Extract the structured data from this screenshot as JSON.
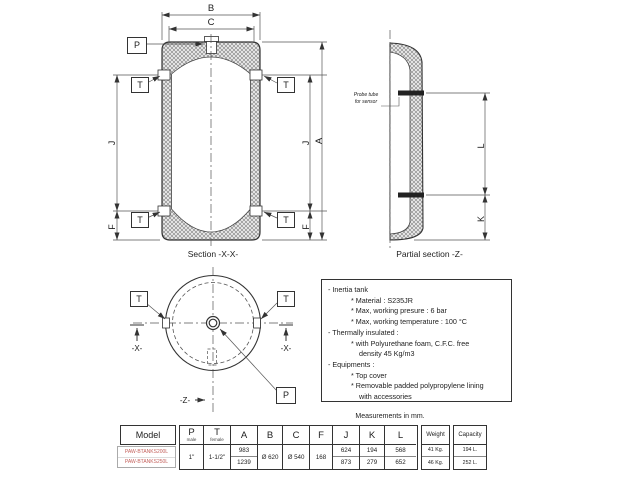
{
  "colors": {
    "line": "#333333",
    "model_text": "#c4615c"
  },
  "section_x": {
    "caption": "Section -X-X-",
    "dim_B": "B",
    "dim_C": "C",
    "dim_A": "A",
    "dim_J": "J",
    "dim_F": "F",
    "label_P": "P",
    "label_T": "T"
  },
  "partial_z": {
    "caption": "Partial section -Z-",
    "dim_L": "L",
    "dim_K": "K",
    "probe_note_line1": "Probe tube",
    "probe_note_line2": "for sensor"
  },
  "top_view": {
    "label_T": "T",
    "label_P": "P",
    "marker_x": "-X-",
    "marker_z": "-Z-"
  },
  "specs": {
    "lines": [
      "- Inertia tank",
      "* Material : S235JR",
      "* Max, working presure : 6 bar",
      "* Max, working temperature : 100 °C",
      "- Thermally insulated :",
      "* with Polyurethane foam, C.F.C. free",
      "density 45 Kg/m3",
      "- Equipments :",
      "* Top cover",
      "* Removable padded polypropylene lining",
      "with accessories"
    ]
  },
  "table": {
    "note": "Measurements in mm.",
    "model": {
      "header": "Model",
      "rows": [
        "PAW-BTANKS200L",
        "PAW-BTANKS250L"
      ]
    },
    "columns": {
      "P": {
        "label": "P",
        "sub": "male",
        "value": "1\""
      },
      "T": {
        "label": "T",
        "sub": "female",
        "value": "1-1/2\""
      },
      "A": {
        "label": "A",
        "values": [
          "983",
          "1239"
        ]
      },
      "B": {
        "label": "B",
        "value": "Ø 620"
      },
      "C": {
        "label": "C",
        "value": "Ø 540"
      },
      "F": {
        "label": "F",
        "value": "168"
      },
      "J": {
        "label": "J",
        "values": [
          "624",
          "873"
        ]
      },
      "K": {
        "label": "K",
        "values": [
          "194",
          "279"
        ]
      },
      "L": {
        "label": "L",
        "values": [
          "568",
          "652"
        ]
      }
    },
    "weight": {
      "header": "Weight",
      "values": [
        "41 Kg.",
        "46 Kg."
      ]
    },
    "capacity": {
      "header": "Capacity",
      "values": [
        "194 L.",
        "252 L."
      ]
    }
  }
}
